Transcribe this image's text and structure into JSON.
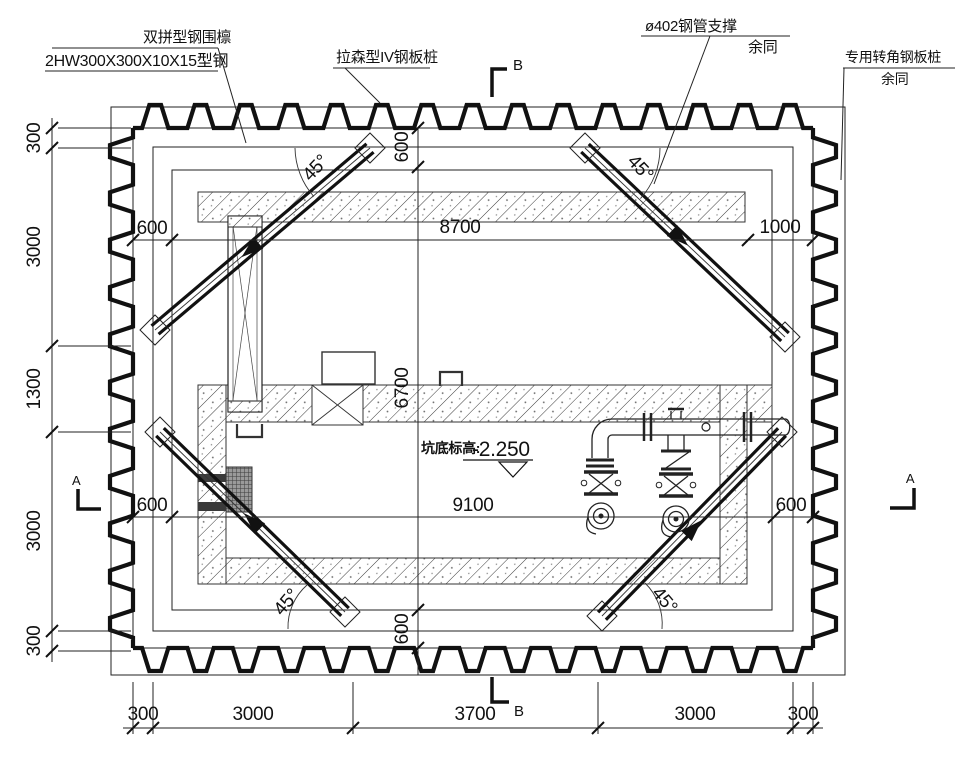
{
  "drawing": {
    "labels": {
      "waler_line1": "双拼型钢围檩",
      "waler_line2": "2HW300X300X10X15型钢",
      "sheet_pile": "拉森型IV钢板桩",
      "pipe_support_line1": "ø402钢管支撑",
      "pipe_support_line2": "余同",
      "corner_pile_line1": "专用转角钢板桩",
      "corner_pile_line2": "余同",
      "pit_elevation_label": "坑底标高:",
      "pit_elevation_value": "-2.250",
      "angle": "45°"
    },
    "dimensions": {
      "left": [
        "300",
        "3000",
        "1300",
        "3000",
        "300"
      ],
      "bottom": [
        "300",
        "3000",
        "3700",
        "3000",
        "300"
      ],
      "top_row": [
        "600",
        "8700",
        "1000"
      ],
      "mid_row": [
        "600",
        "9100",
        "600"
      ],
      "vstack": [
        "600",
        "6700",
        "600"
      ]
    },
    "sections": {
      "a": "A",
      "b": "B"
    }
  }
}
